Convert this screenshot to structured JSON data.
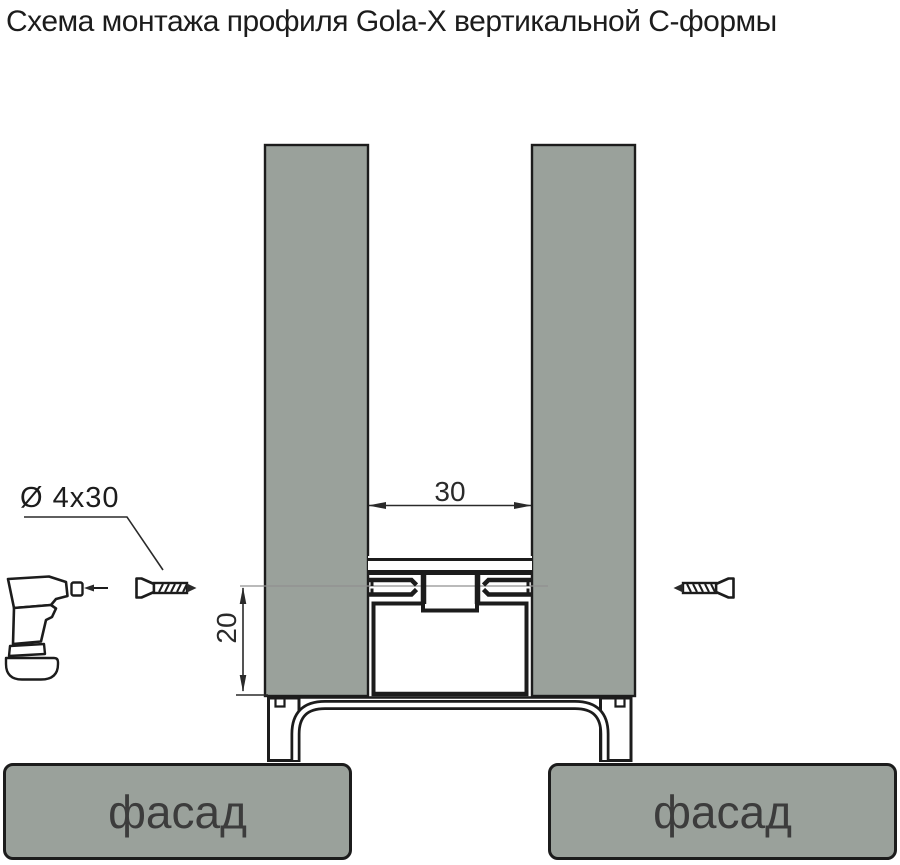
{
  "title": "Схема монтажа профиля Gola-X вертикальной С-формы",
  "labels": {
    "screw_size": "Ø 4x30",
    "gap_width": "30",
    "screw_depth": "20",
    "facade_left": "фасад",
    "facade_right": "фасад"
  },
  "icons": {
    "drill": "cordless-drill-icon",
    "screw_left": "countersunk-screw-icon",
    "screw_right": "countersunk-screw-icon"
  },
  "colors": {
    "panel": "#9aa19b",
    "outline": "#1c1c1c",
    "dim-line": "#2a2a2a",
    "centerline": "#909090",
    "facade-text": "#3c3c3c",
    "bg": "#ffffff"
  }
}
